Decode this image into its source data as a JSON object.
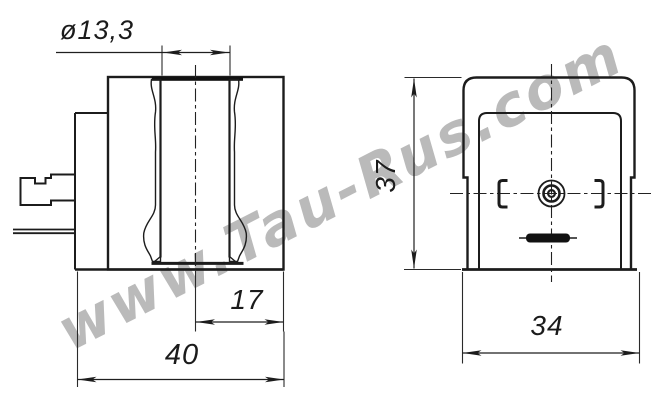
{
  "watermark": {
    "text": "www.Tau-Rus.com",
    "color": "#b1b1b1"
  },
  "drawing": {
    "line_color": "#1c1c1c",
    "background_color": "#ffffff",
    "dimensions": {
      "bore_diameter": {
        "label": "ø13,3",
        "value_mm": 13.3
      },
      "bore_offset": {
        "label": "17",
        "value_mm": 17
      },
      "overall_width": {
        "label": "40",
        "value_mm": 40
      },
      "body_height": {
        "label": "37",
        "value_mm": 37
      },
      "body_width": {
        "label": "34",
        "value_mm": 34
      }
    }
  }
}
